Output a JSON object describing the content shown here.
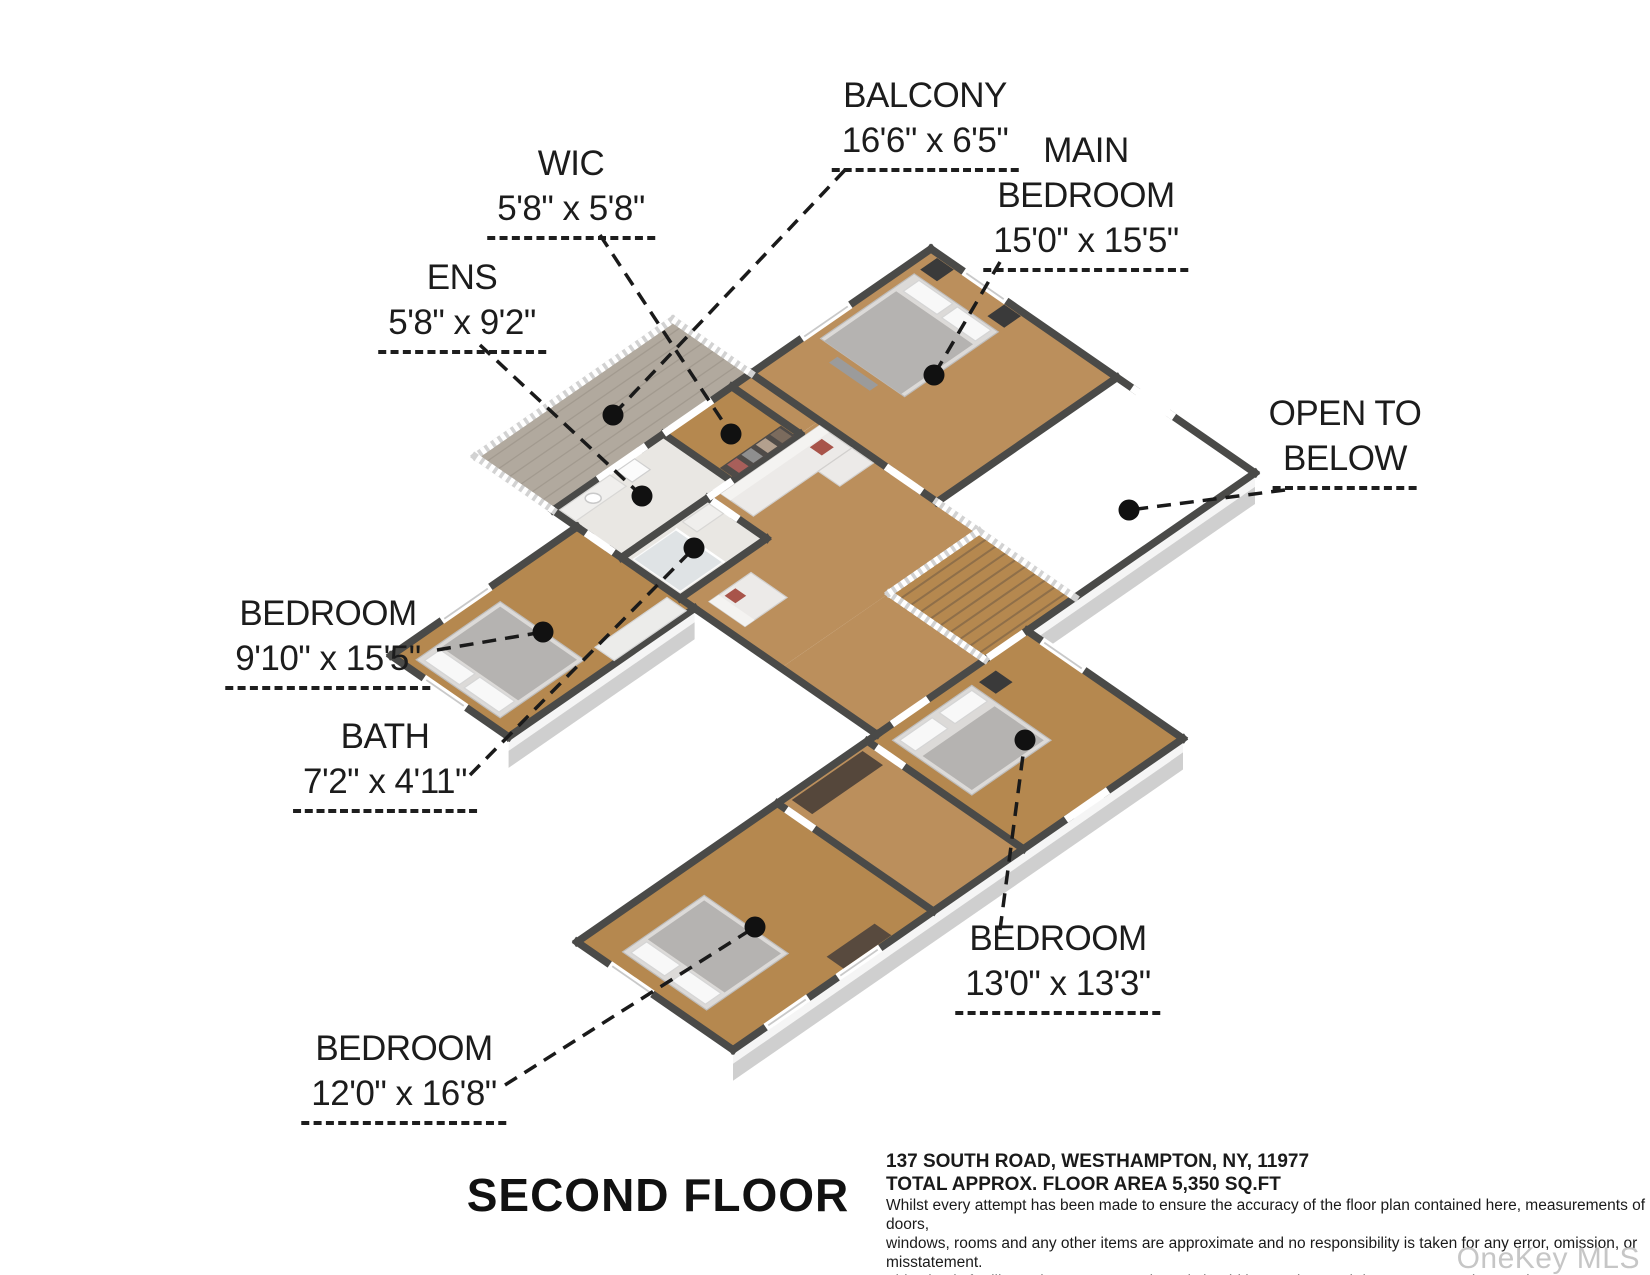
{
  "floor_plan": {
    "title": "SECOND FLOOR",
    "watermark": "OneKey MLS",
    "rooms": {
      "balcony": {
        "name": "BALCONY",
        "dims": "16'6\" x 6'5\""
      },
      "wic": {
        "name": "WIC",
        "dims": "5'8\" x 5'8\""
      },
      "main_bedroom": {
        "name_line1": "MAIN",
        "name_line2": "BEDROOM",
        "dims": "15'0\" x 15'5\""
      },
      "ens": {
        "name": "ENS",
        "dims": "5'8\" x 9'2\""
      },
      "open_below": {
        "name_line1": "OPEN TO",
        "name_line2": "BELOW"
      },
      "bedroom_left": {
        "name": "BEDROOM",
        "dims": "9'10\" x 15'5\""
      },
      "bath": {
        "name": "BATH",
        "dims": "7'2\" x 4'11\""
      },
      "bedroom_bottom_left": {
        "name": "BEDROOM",
        "dims": "12'0\" x 16'8\""
      },
      "bedroom_bottom_right": {
        "name": "BEDROOM",
        "dims": "13'0\" x 13'3\""
      }
    },
    "footer": {
      "address": "137 SOUTH ROAD, WESTHAMPTON, NY, 11977",
      "area": "TOTAL APPROX. FLOOR AREA 5,350 SQ.FT",
      "disclaimer_line1": "Whilst every attempt has been made to ensure the accuracy of the floor plan contained here, measurements of doors,",
      "disclaimer_line2": "windows, rooms and any other items are approximate and no responsibility is taken for any error, omission, or misstatement.",
      "disclaimer_line3": "This plan is for illustrative purposes only and should be used as such by any prospective purchaser."
    },
    "colors": {
      "wood": "#bb8f5c",
      "wood_alt": "#b5884f",
      "tile": "#e9e7e3",
      "deck": "#b1a99e",
      "wall_cap": "#4a4a48",
      "wall_face": "#f5f5f5",
      "wall_face_side": "#e9e9e9",
      "slab": "#cfcfcf",
      "slab_side": "#c2c2c2",
      "open_floor": "#ffffff",
      "leader": "#1a1a1a",
      "accent_red": "#a8544a",
      "watermark": "#c6c6c6"
    }
  }
}
